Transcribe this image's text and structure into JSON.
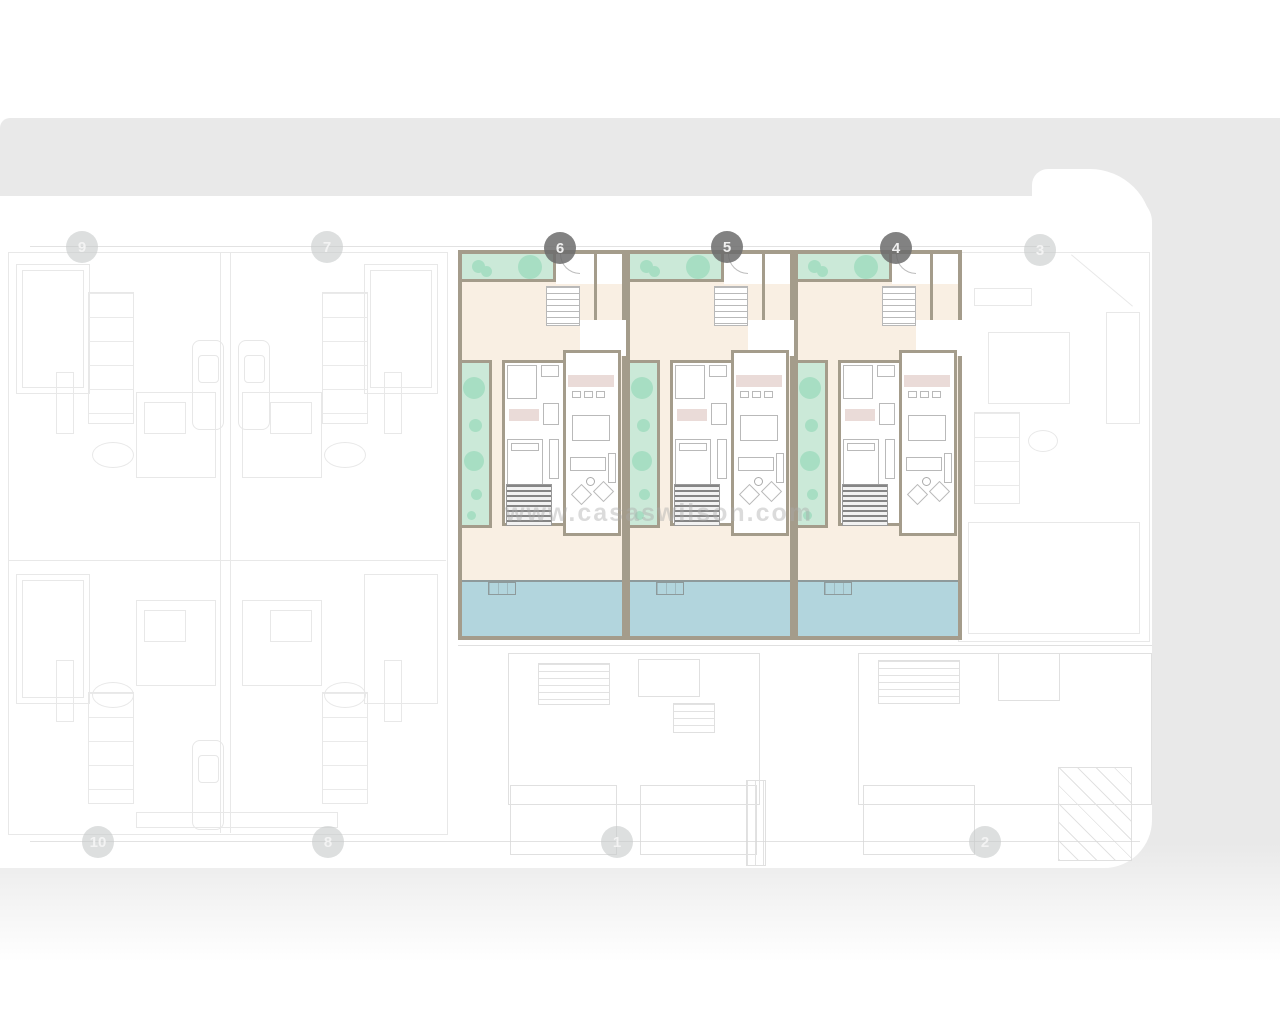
{
  "site_plan": {
    "watermark_text": "www.casaswilson.com",
    "highlighted_unit_numbers": [
      "6",
      "5",
      "4"
    ],
    "plot_badges": [
      {
        "label": "9",
        "x": 82,
        "y": 247,
        "variant": "faded"
      },
      {
        "label": "7",
        "x": 327,
        "y": 247,
        "variant": "faded"
      },
      {
        "label": "6",
        "x": 560,
        "y": 248,
        "variant": "dark"
      },
      {
        "label": "5",
        "x": 727,
        "y": 247,
        "variant": "dark"
      },
      {
        "label": "4",
        "x": 896,
        "y": 248,
        "variant": "dark"
      },
      {
        "label": "3",
        "x": 1040,
        "y": 250,
        "variant": "faded"
      },
      {
        "label": "10",
        "x": 98,
        "y": 842,
        "variant": "faded"
      },
      {
        "label": "8",
        "x": 328,
        "y": 842,
        "variant": "faded"
      },
      {
        "label": "1",
        "x": 617,
        "y": 842,
        "variant": "faded"
      },
      {
        "label": "2",
        "x": 985,
        "y": 842,
        "variant": "faded"
      }
    ],
    "unit_left_positions": [
      458,
      626,
      794
    ],
    "colors": {
      "backdrop": "#e9e9e9",
      "wall": "#a49c8b",
      "terrace": "#f9efe3",
      "garden": "#cbe9d8",
      "tree": "#a7dec3",
      "pool": "#b2d5dd",
      "counter": "#eadbd8"
    }
  }
}
